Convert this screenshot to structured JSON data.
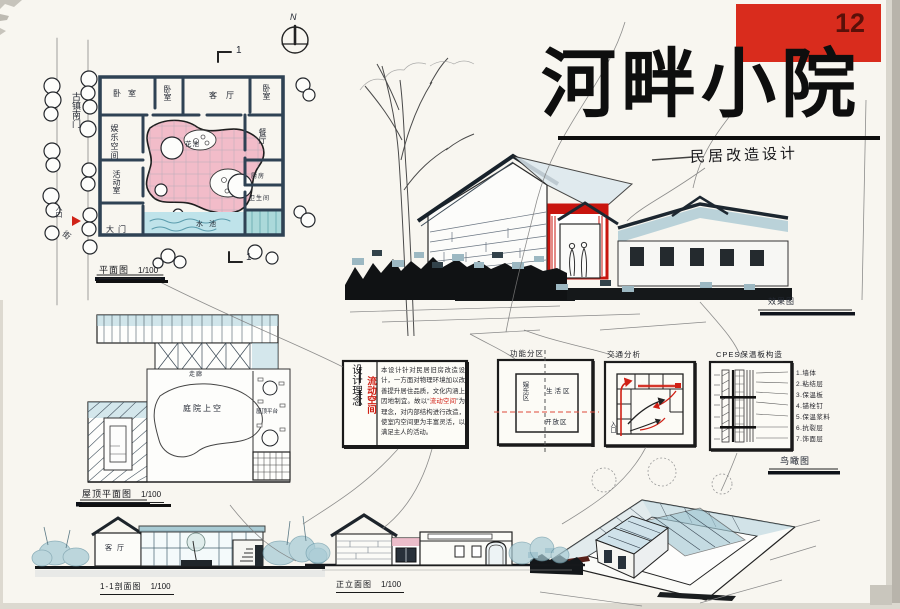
{
  "board": {
    "number": "12",
    "title": "河畔小院",
    "subtitle": "民居改造设计",
    "accent_red": "#d92c1d",
    "wash_blue": "#a9cfdb",
    "wash_pink": "#f2bcc9"
  },
  "floor_plan": {
    "caption": "平面图",
    "scale": "1/100",
    "north": "N",
    "section_mark_top": "1",
    "section_mark_bottom": "1",
    "street_vertical": "古镇南门",
    "entrance": "入口",
    "street2": "街",
    "rooms": {
      "bedroom_a": "卧室",
      "bedroom_b": "卧室",
      "living_room": "客厅",
      "bedroom_c": "卧室",
      "leisure_space": "娱乐空间",
      "activity_room": "活动室",
      "main_gate": "大门",
      "flower_bed": "花池",
      "pond": "水池",
      "dining_room": "餐厅",
      "kitchen": "厨房",
      "bathroom": "卫生间"
    }
  },
  "roof_plan": {
    "caption": "屋顶平面图",
    "scale": "1/100",
    "courtyard_label": "庭院上空",
    "corridor_label": "走廊",
    "terrace_label": "屋顶平台"
  },
  "concept": {
    "heading": "设计理念",
    "keyword": "流动空间",
    "body_before": "本设计针对民居旧房改造设计，一方面对物理环境加以改善提升居住品质，文化内涵上因地制宜。故以“",
    "keyword_inline": "流动空间",
    "body_after": "”为理念，对内部结构进行改造，使室内空间更为丰富灵活，以满足主人的活动。"
  },
  "diagrams": {
    "zoning": {
      "caption": "功能分区",
      "zone_left": "娱乐区",
      "zone_center": "生活区",
      "zone_bottom": "开放区"
    },
    "circulation": {
      "caption": "交通分析",
      "entrance": "入口"
    },
    "wall": {
      "caption": "CPES保温板构造",
      "legend": [
        "1.墙体",
        "2.粘结层",
        "3.保温板",
        "4.锚栓钉",
        "5.保温浆料",
        "6.抗裂层",
        "7.饰面层"
      ]
    }
  },
  "perspective": {
    "caption": "效果图"
  },
  "axonometric": {
    "caption": "鸟瞰图"
  },
  "section": {
    "caption": "1-1剖面图",
    "scale": "1/100",
    "room": "客厅"
  },
  "elevation": {
    "caption": "正立面图",
    "scale": "1/100"
  }
}
